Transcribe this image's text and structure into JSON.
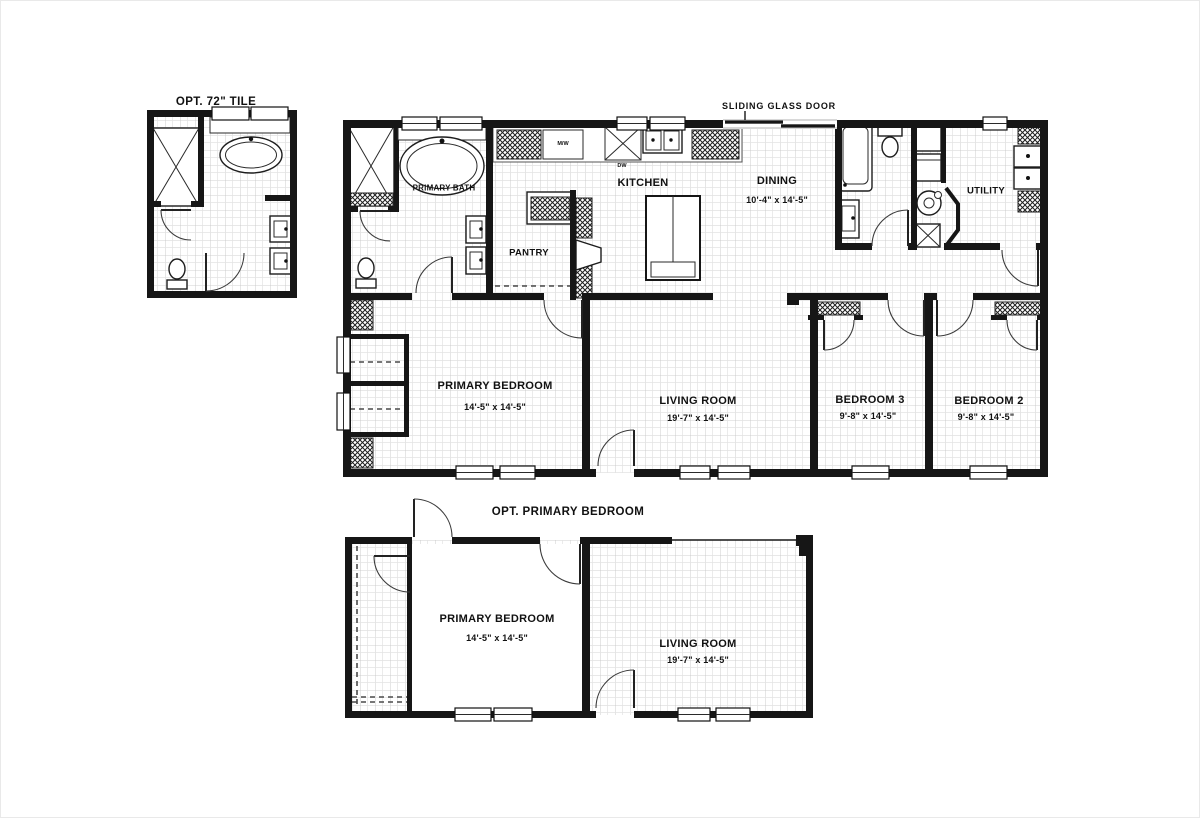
{
  "colors": {
    "wall": "#161616",
    "tile_line": "#c2c2c2",
    "tile_line_light": "#e3e3e3",
    "hatch": "#1f1f1f",
    "background": "#ffffff",
    "label": "#111111"
  },
  "opt_tile_plan": {
    "title": "OPT. 72\" TILE"
  },
  "main_plan": {
    "sliding_door_label": "SLIDING GLASS DOOR",
    "rooms": {
      "primary_bath": {
        "label": "PRIMARY BATH"
      },
      "pantry": {
        "label": "PANTRY"
      },
      "kitchen": {
        "label": "KITCHEN"
      },
      "dining": {
        "label": "DINING",
        "dims": "10'-4\" x 14'-5\""
      },
      "utility": {
        "label": "UTILITY"
      },
      "primary_bedroom": {
        "label": "PRIMARY BEDROOM",
        "dims": "14'-5\" x 14'-5\""
      },
      "living_room": {
        "label": "LIVING ROOM",
        "dims": "19'-7\" x 14'-5\""
      },
      "bedroom_3": {
        "label": "BEDROOM 3",
        "dims": "9'-8\" x 14'-5\""
      },
      "bedroom_2": {
        "label": "BEDROOM 2",
        "dims": "9'-8\" x 14'-5\""
      }
    },
    "appliances": {
      "microwave": "M/W",
      "dishwasher": "DW"
    }
  },
  "opt_primary_plan": {
    "title": "OPT. PRIMARY BEDROOM",
    "rooms": {
      "primary_bedroom": {
        "label": "PRIMARY BEDROOM",
        "dims": "14'-5\" x 14'-5\""
      },
      "living_room": {
        "label": "LIVING ROOM",
        "dims": "19'-7\" x 14'-5\""
      }
    }
  }
}
